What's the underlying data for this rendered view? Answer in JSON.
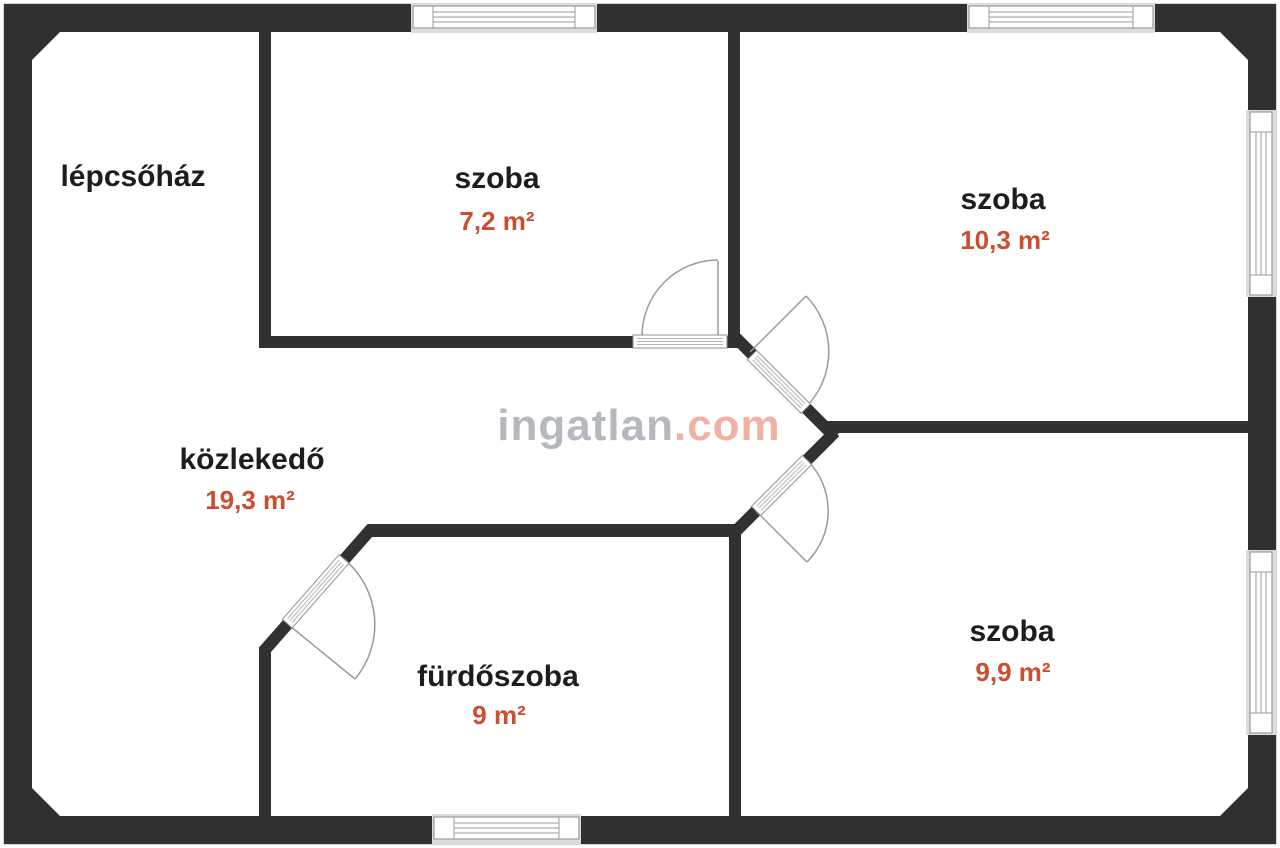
{
  "meta": {
    "document_type": "apartment floor plan",
    "watermark_site": "ingatlan.com"
  },
  "watermark": {
    "part1": "ingatlan",
    "part2": ".com"
  },
  "rooms": [
    {
      "id": "lepcsohaz",
      "name": "lépcsőház",
      "area": ""
    },
    {
      "id": "szoba-1",
      "name": "szoba",
      "area": "7,2 m²"
    },
    {
      "id": "szoba-2",
      "name": "szoba",
      "area": "10,3 m²"
    },
    {
      "id": "kozlekedo",
      "name": "közlekedő",
      "area": "19,3 m²"
    },
    {
      "id": "furdoszoba",
      "name": "fürdőszoba",
      "area": "9 m²"
    },
    {
      "id": "szoba-3",
      "name": "szoba",
      "area": "9,9 m²"
    }
  ],
  "colors": {
    "wall": "#313133",
    "room_label": "#1d1d1d",
    "area_accent": "#cb4e31",
    "watermark_gray": "#b5b8be",
    "watermark_red": "#f1b2a3",
    "window_outline": "#9b9b9b",
    "background": "#ffffff"
  },
  "counts": {
    "windows": "5",
    "doors": "4"
  }
}
